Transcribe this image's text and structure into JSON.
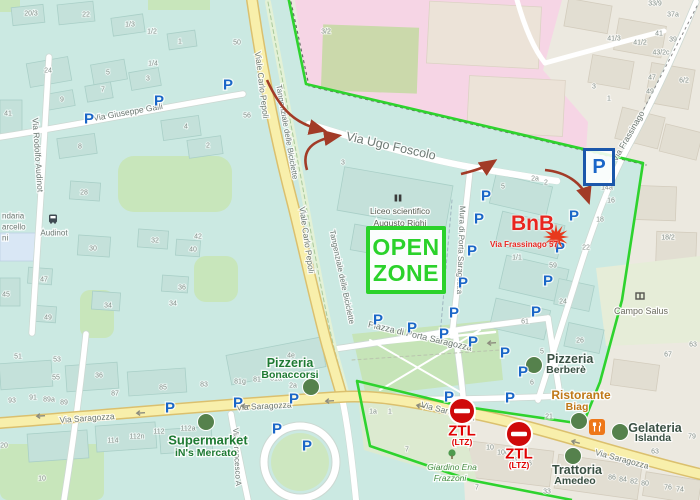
{
  "colors": {
    "zone_green": "#2ed32e",
    "parking_blue": "#1a66c8",
    "ztl_red": "#cf0a0a",
    "route_arrow": "#a23b27",
    "bnb_red": "#e8251f",
    "poi_dot_green": "#55814c",
    "custom_green": "#1f7a33",
    "custom_dark": "#3a5044",
    "restaurant_orange": "#c07818"
  },
  "zone": {
    "boundary_points": "288,-4 306,84 643,163 622,300 600,382 583,424 460,406 357,381 370,446 470,480 572,500"
  },
  "annotations": {
    "open_zone": {
      "line1": "OPEN",
      "line2": "ZONE",
      "color": "#2bd22b"
    },
    "bnb": {
      "title": "BnB",
      "address": "Via Frassinago 57",
      "star": {
        "x": 556,
        "y": 237,
        "spikes": 12,
        "r1": 13,
        "r2": 5.5,
        "color": "#e8391d"
      }
    },
    "parking_box": {
      "letter": "P"
    },
    "ztl_signs": [
      {
        "label": "ZTL",
        "sub": "(LTZ)",
        "x": 462,
        "y": 411
      },
      {
        "label": "ZTL",
        "sub": "(LTZ)",
        "x": 519,
        "y": 434
      }
    ],
    "route_arrows": [
      "M267,80 C281,111 296,124 322,130",
      "M307,170 C301,150 312,140 337,136",
      "M461,174 C473,171 484,168 493,162",
      "M545,170 C565,172 582,182 588,200"
    ]
  },
  "parking": {
    "letter": "P",
    "positions": [
      [
        89,
        119
      ],
      [
        159,
        101
      ],
      [
        228,
        85
      ],
      [
        486,
        196
      ],
      [
        479,
        219
      ],
      [
        472,
        251
      ],
      [
        574,
        216
      ],
      [
        560,
        248
      ],
      [
        548,
        281
      ],
      [
        463,
        283
      ],
      [
        454,
        313
      ],
      [
        536,
        312
      ],
      [
        412,
        328
      ],
      [
        444,
        334
      ],
      [
        473,
        342
      ],
      [
        505,
        353
      ],
      [
        523,
        372
      ],
      [
        510,
        398
      ],
      [
        378,
        320
      ],
      [
        170,
        408
      ],
      [
        238,
        403
      ],
      [
        294,
        399
      ],
      [
        277,
        429
      ],
      [
        307,
        446
      ],
      [
        449,
        397
      ]
    ]
  },
  "poi_dots": [
    [
      311,
      387
    ],
    [
      206,
      422
    ],
    [
      534,
      365
    ],
    [
      579,
      421
    ],
    [
      620,
      432
    ],
    [
      573,
      456
    ]
  ],
  "labels": [
    {
      "t": "Liceo scientifico",
      "x": 400,
      "y": 211,
      "fs": 8.5,
      "c": "#585d52"
    },
    {
      "t": "Augusto Righi",
      "x": 400,
      "y": 223,
      "fs": 8.5,
      "c": "#585d52"
    },
    {
      "t": "Campo Salus",
      "x": 641,
      "y": 311,
      "fs": 9,
      "c": "#6c6c60"
    },
    {
      "t": "Giardino Ena",
      "x": 452,
      "y": 467,
      "fs": 8.5,
      "c": "#4a8f46",
      "i": true
    },
    {
      "t": "Frazzoni",
      "x": 450,
      "y": 478,
      "fs": 8.5,
      "c": "#4a8f46",
      "i": true
    },
    {
      "t": "Ristorante",
      "x": 581,
      "y": 395,
      "fs": 12,
      "c": "#c07818",
      "b": true
    },
    {
      "t": "Biag",
      "x": 577,
      "y": 407,
      "fs": 10.5,
      "c": "#c07818",
      "b": true
    },
    {
      "t": "Pizzeria",
      "x": 290,
      "y": 363,
      "fs": 12.5,
      "c": "#1f7a33",
      "b": true
    },
    {
      "t": "Bonaccorsi",
      "x": 290,
      "y": 375,
      "fs": 10.5,
      "c": "#1f7a33",
      "b": true
    },
    {
      "t": "Supermarket",
      "x": 208,
      "y": 440,
      "fs": 13,
      "c": "#1f7a33",
      "b": true
    },
    {
      "t": "iN's Mercato",
      "x": 206,
      "y": 453,
      "fs": 10.5,
      "c": "#1f7a33",
      "b": true
    },
    {
      "t": "Pizzeria",
      "x": 570,
      "y": 359,
      "fs": 12.5,
      "c": "#3a5044",
      "b": true
    },
    {
      "t": "Berberè",
      "x": 566,
      "y": 370,
      "fs": 10.5,
      "c": "#3a5044",
      "b": true
    },
    {
      "t": "Gelateria",
      "x": 655,
      "y": 428,
      "fs": 12.5,
      "c": "#3a5044",
      "b": true
    },
    {
      "t": "Islanda",
      "x": 653,
      "y": 438,
      "fs": 10.5,
      "c": "#3a5044",
      "b": true
    },
    {
      "t": "Trattoria",
      "x": 577,
      "y": 470,
      "fs": 12.5,
      "c": "#3a5044",
      "b": true
    },
    {
      "t": "Amedeo",
      "x": 575,
      "y": 481,
      "fs": 10.5,
      "c": "#3a5044",
      "b": true
    }
  ],
  "street_labels": [
    {
      "t": "Via Giuseppe Galli",
      "x": 128,
      "y": 112,
      "r": -10,
      "fs": 8.5
    },
    {
      "t": "Via Rodolfo Audinot",
      "x": 38,
      "y": 155,
      "r": 86,
      "fs": 8.5
    },
    {
      "t": "Audinot",
      "x": 54,
      "y": 233,
      "r": 0,
      "fs": 8,
      "c": "#45525c"
    },
    {
      "t": "Viale Carlo Pepoli",
      "x": 262,
      "y": 85,
      "r": 83,
      "fs": 8.5
    },
    {
      "t": "Viale Carlo Pepoli",
      "x": 307,
      "y": 240,
      "r": 82,
      "fs": 8.5
    },
    {
      "t": "Tangenziale delle Biciclette",
      "x": 287,
      "y": 132,
      "r": 80,
      "fs": 8,
      "c": "#5c9452"
    },
    {
      "t": "Tangenziale delle Biciclette",
      "x": 342,
      "y": 277,
      "r": 78,
      "fs": 8,
      "c": "#5c9452"
    },
    {
      "t": "Via Ugo Foscolo",
      "x": 391,
      "y": 146,
      "r": 12.5,
      "fs": 12.5,
      "c": "#4a524e"
    },
    {
      "t": "Mura di Porta Saragozza",
      "x": 461,
      "y": 250,
      "r": 92,
      "fs": 8
    },
    {
      "t": "Via Frassinago",
      "x": 628,
      "y": 136,
      "r": -60,
      "fs": 8.5
    },
    {
      "t": "Piazza di Porta Saragozza",
      "x": 420,
      "y": 336,
      "r": 13,
      "fs": 9
    },
    {
      "t": "Via Saragozza",
      "x": 87,
      "y": 418,
      "r": -4,
      "fs": 8.5
    },
    {
      "t": "Via Saragozza",
      "x": 264,
      "y": 406,
      "r": -3,
      "fs": 8.5
    },
    {
      "t": "Via Saragozza",
      "x": 448,
      "y": 411,
      "r": 14,
      "fs": 8.5
    },
    {
      "t": "Via Saragozza",
      "x": 622,
      "y": 459,
      "r": 15,
      "fs": 8.5
    },
    {
      "t": "Via Francesco A",
      "x": 237,
      "y": 457,
      "r": 87,
      "fs": 8
    },
    {
      "t": "ndaria",
      "x": 2,
      "y": 216,
      "r": 0,
      "fs": 8,
      "c": "#4c5a64",
      "a": "s"
    },
    {
      "t": "arcello",
      "x": 2,
      "y": 227,
      "r": 0,
      "fs": 8,
      "c": "#4c5a64",
      "a": "s"
    },
    {
      "t": "ni",
      "x": 2,
      "y": 238,
      "r": 0,
      "fs": 8,
      "c": "#4c5a64",
      "a": "s"
    }
  ],
  "house_numbers": [
    [
      "20/3",
      31,
      14
    ],
    [
      "22",
      86,
      15
    ],
    [
      "1/3",
      130,
      25
    ],
    [
      "1/2",
      152,
      32
    ],
    [
      "1",
      180,
      42
    ],
    [
      "1/4",
      153,
      64
    ],
    [
      "24",
      48,
      71
    ],
    [
      "5",
      108,
      73
    ],
    [
      "3",
      148,
      79
    ],
    [
      "7",
      103,
      90
    ],
    [
      "9",
      62,
      100
    ],
    [
      "41",
      8,
      114
    ],
    [
      "4",
      186,
      127
    ],
    [
      "2",
      208,
      146
    ],
    [
      "8",
      80,
      147
    ],
    [
      "50",
      237,
      43
    ],
    [
      "56",
      247,
      116
    ],
    [
      "3/2",
      326,
      32
    ],
    [
      "28",
      84,
      193
    ],
    [
      "30",
      93,
      249
    ],
    [
      "32",
      155,
      241
    ],
    [
      "34",
      108,
      306
    ],
    [
      "34",
      173,
      304
    ],
    [
      "36",
      182,
      288
    ],
    [
      "40",
      193,
      250
    ],
    [
      "42",
      198,
      237
    ],
    [
      "45",
      6,
      295
    ],
    [
      "47",
      44,
      280
    ],
    [
      "49",
      48,
      318
    ],
    [
      "33/9",
      655,
      4
    ],
    [
      "37a",
      673,
      15
    ],
    [
      "41/3",
      614,
      39
    ],
    [
      "41/2",
      640,
      43
    ],
    [
      "41",
      659,
      34
    ],
    [
      "39",
      673,
      40
    ],
    [
      "43/2c",
      661,
      53
    ],
    [
      "47",
      652,
      78
    ],
    [
      "49",
      650,
      92
    ],
    [
      "6/2",
      684,
      81
    ],
    [
      "3",
      594,
      87
    ],
    [
      "1",
      609,
      99
    ],
    [
      "18/2",
      668,
      238
    ],
    [
      "3",
      343,
      163
    ],
    [
      "5",
      503,
      187
    ],
    [
      "2a",
      535,
      179
    ],
    [
      "2",
      546,
      183
    ],
    [
      "14a",
      607,
      188
    ],
    [
      "16",
      611,
      201
    ],
    [
      "18",
      600,
      220
    ],
    [
      "22",
      586,
      248
    ],
    [
      "1/1",
      517,
      258
    ],
    [
      "59",
      553,
      266
    ],
    [
      "24",
      563,
      302
    ],
    [
      "26",
      580,
      341
    ],
    [
      "61",
      525,
      322
    ],
    [
      "5",
      542,
      352
    ],
    [
      "6",
      532,
      383
    ],
    [
      "63",
      693,
      345
    ],
    [
      "67",
      668,
      355
    ],
    [
      "4e",
      291,
      356
    ],
    [
      "81g",
      240,
      382
    ],
    [
      "81",
      257,
      380
    ],
    [
      "81a",
      276,
      379
    ],
    [
      "2a",
      293,
      386
    ],
    [
      "83",
      204,
      385
    ],
    [
      "85",
      163,
      388
    ],
    [
      "87",
      115,
      394
    ],
    [
      "36",
      99,
      376
    ],
    [
      "51",
      18,
      357
    ],
    [
      "53",
      57,
      360
    ],
    [
      "55",
      56,
      378
    ],
    [
      "93",
      12,
      401
    ],
    [
      "91",
      33,
      398
    ],
    [
      "89a",
      49,
      400
    ],
    [
      "89",
      64,
      403
    ],
    [
      "114",
      113,
      441
    ],
    [
      "112n",
      137,
      437
    ],
    [
      "112",
      159,
      432
    ],
    [
      "112a",
      188,
      429
    ],
    [
      "10",
      42,
      479
    ],
    [
      "20",
      4,
      446
    ],
    [
      "1a",
      373,
      412
    ],
    [
      "1",
      390,
      412
    ],
    [
      "7",
      407,
      450
    ],
    [
      "7",
      477,
      488
    ],
    [
      "10",
      490,
      448
    ],
    [
      "100",
      503,
      453
    ],
    [
      "98",
      513,
      460
    ],
    [
      "96",
      528,
      464
    ],
    [
      "33",
      547,
      492
    ],
    [
      "86",
      612,
      478
    ],
    [
      "84",
      623,
      480
    ],
    [
      "82",
      634,
      482
    ],
    [
      "80",
      645,
      484
    ],
    [
      "76",
      668,
      488
    ],
    [
      "74",
      680,
      490
    ],
    [
      "63",
      655,
      452
    ],
    [
      "79",
      692,
      437
    ],
    [
      "21",
      549,
      417
    ]
  ],
  "icons": [
    {
      "type": "bus-icon",
      "x": 53,
      "y": 219
    },
    {
      "type": "school-icon",
      "x": 398,
      "y": 198
    },
    {
      "type": "sport-icon",
      "x": 640,
      "y": 296
    },
    {
      "type": "tree-icon",
      "x": 452,
      "y": 455
    },
    {
      "type": "restaurant-icon",
      "x": 597,
      "y": 427
    },
    {
      "type": "oneway-arrow-icon",
      "x": 40,
      "y": 416,
      "r": -4
    },
    {
      "type": "oneway-arrow-icon",
      "x": 140,
      "y": 413,
      "r": -4
    },
    {
      "type": "oneway-arrow-icon",
      "x": 245,
      "y": 406,
      "r": -3
    },
    {
      "type": "oneway-arrow-icon",
      "x": 329,
      "y": 401,
      "r": -4
    },
    {
      "type": "oneway-arrow-icon",
      "x": 420,
      "y": 406,
      "r": 13
    },
    {
      "type": "oneway-arrow-icon",
      "x": 575,
      "y": 442,
      "r": 15
    },
    {
      "type": "oneway-arrow-icon",
      "x": 491,
      "y": 343,
      "r": -3
    }
  ],
  "transit": {
    "bus_stop_label": "Audinot"
  }
}
